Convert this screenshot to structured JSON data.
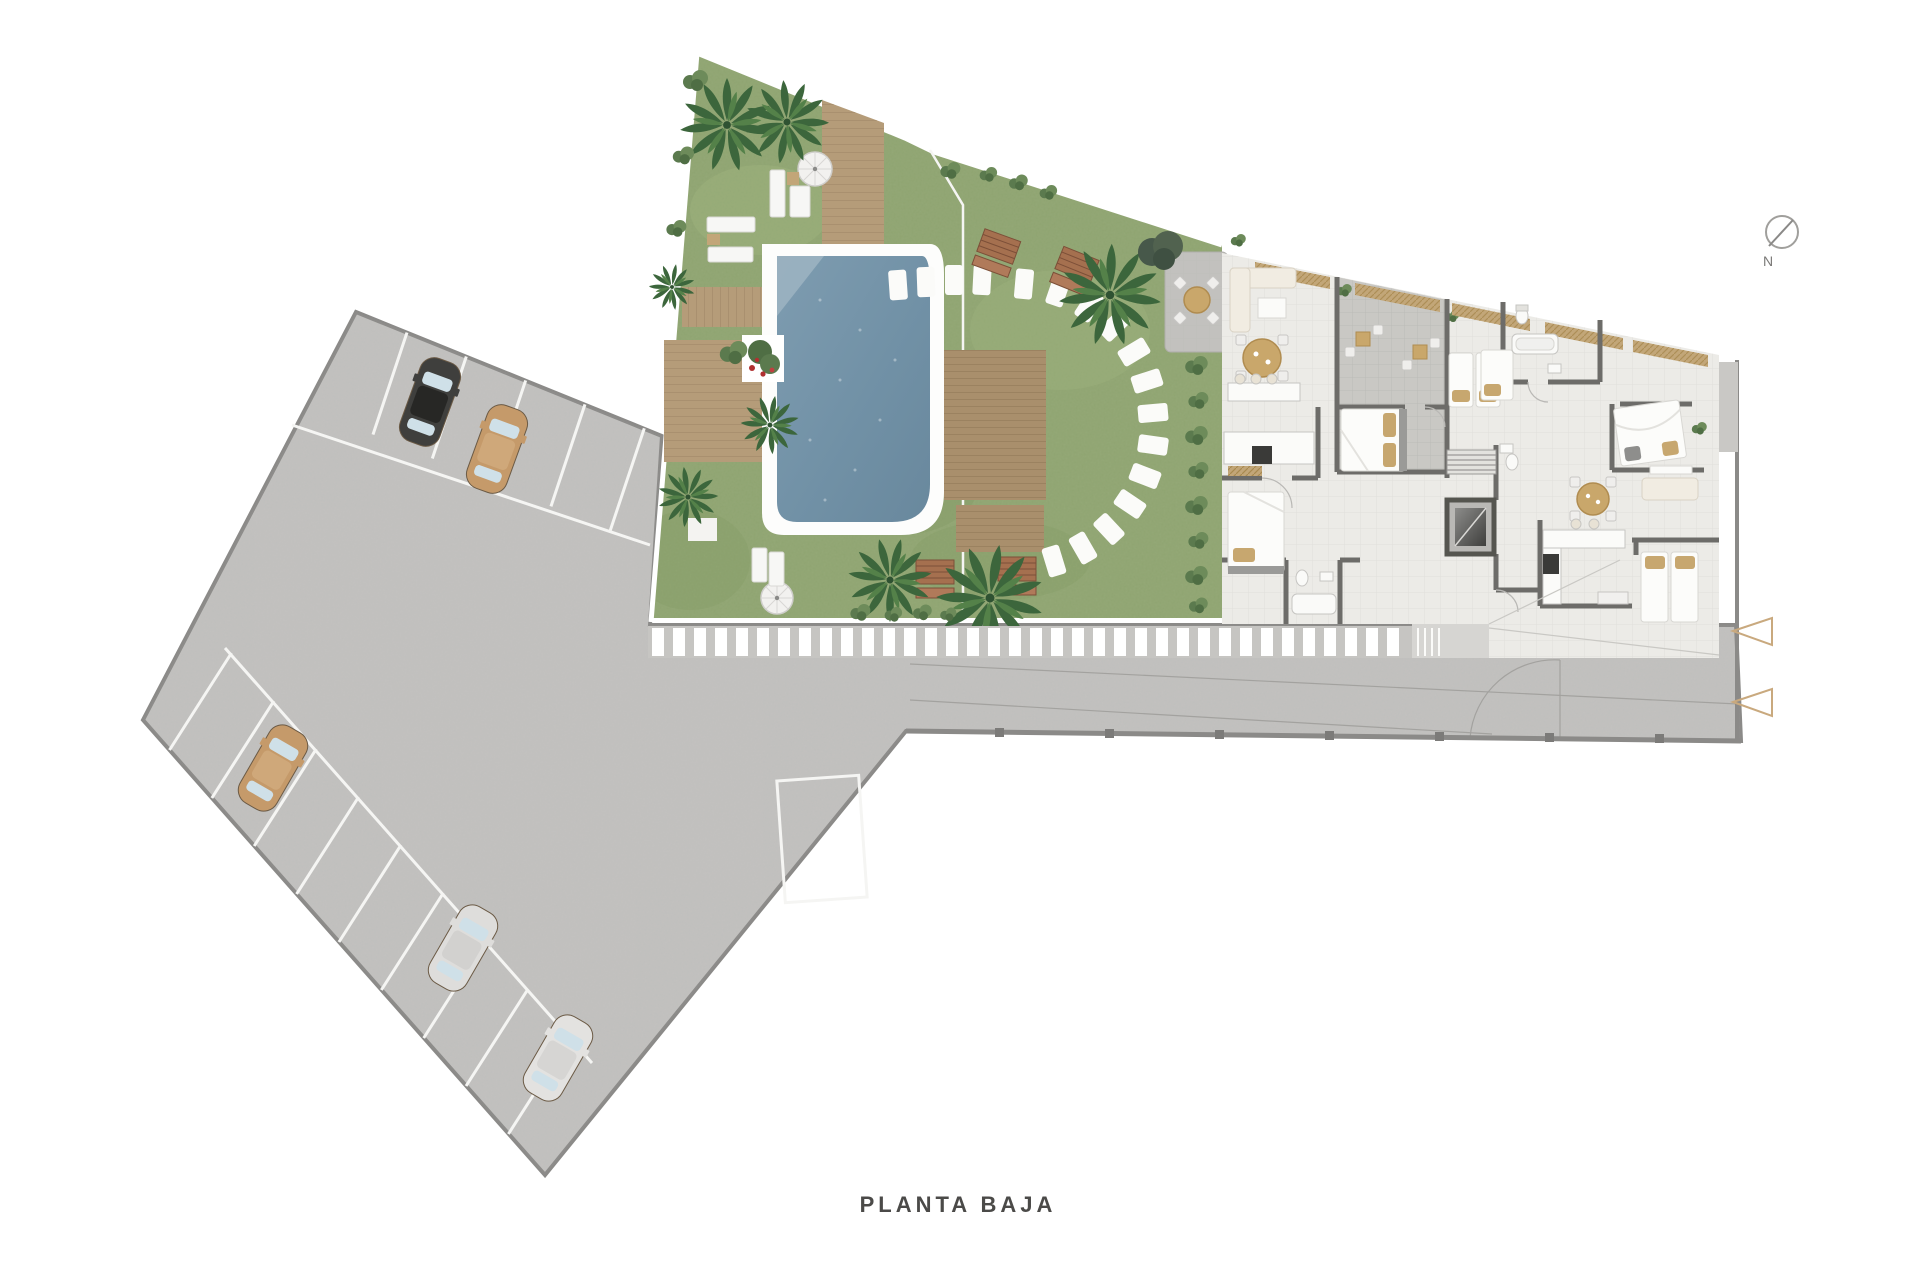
{
  "title": {
    "label": "PLANTA BAJA"
  },
  "compass": {
    "label": "N",
    "icon": "compass-icon"
  },
  "markers": {
    "shape": "left-pointing-triangle-outline",
    "color": "#c9a97e",
    "items": [
      {
        "x": 1733,
        "y": 631
      },
      {
        "x": 1733,
        "y": 702
      }
    ]
  },
  "parking": {
    "cars": [
      {
        "name": "black-car",
        "body": "#3f3f3d",
        "roof": "#272725",
        "x": 430,
        "y": 402,
        "rot": 20
      },
      {
        "name": "tan-car",
        "body": "#c59a6a",
        "roof": "#cfa87a",
        "x": 497,
        "y": 449,
        "rot": 20
      },
      {
        "name": "tan-car",
        "body": "#c59a6a",
        "roof": "#cfa87a",
        "x": 273,
        "y": 768,
        "rot": 30
      },
      {
        "name": "silver-car",
        "body": "#dedddb",
        "roof": "#d2d1cf",
        "x": 463,
        "y": 948,
        "rot": 30
      },
      {
        "name": "silver-car",
        "body": "#e3e2e0",
        "roof": "#d6d5d3",
        "x": 558,
        "y": 1058,
        "rot": 30
      }
    ],
    "stall_rows": [
      {
        "start": [
          356,
          312
        ],
        "unit": [
          0.927,
          0.374
        ],
        "first": 55,
        "spacing": 64,
        "count": 5,
        "stall": [
          -34,
          102
        ]
      },
      {
        "start": [
          143,
          720
        ],
        "unit": [
          0.662,
          0.75
        ],
        "first": 40,
        "spacing": 64,
        "count": 9,
        "stall": [
          62,
          -97
        ]
      }
    ]
  },
  "site_areas": [
    "parking-lot",
    "access-road",
    "pool-garden",
    "swimming-pool",
    "apartment-building",
    "roof-terraces"
  ],
  "palette": {
    "asphalt": "#c3c2c0",
    "asphalt_edge": "#8b8a88",
    "lawn": "#8fa471",
    "pool_water": "#7494a9",
    "deck_wood": "#b59c79",
    "pergola_wood": "#a98f6c",
    "bench_wood": "#a5704f",
    "wall": "#6d6c69",
    "floor": "#ecebe7",
    "terrace": "#c9c8c4",
    "accent_tan": "#c2a678",
    "marker": "#c9a97e",
    "text": "#4b4a48"
  }
}
